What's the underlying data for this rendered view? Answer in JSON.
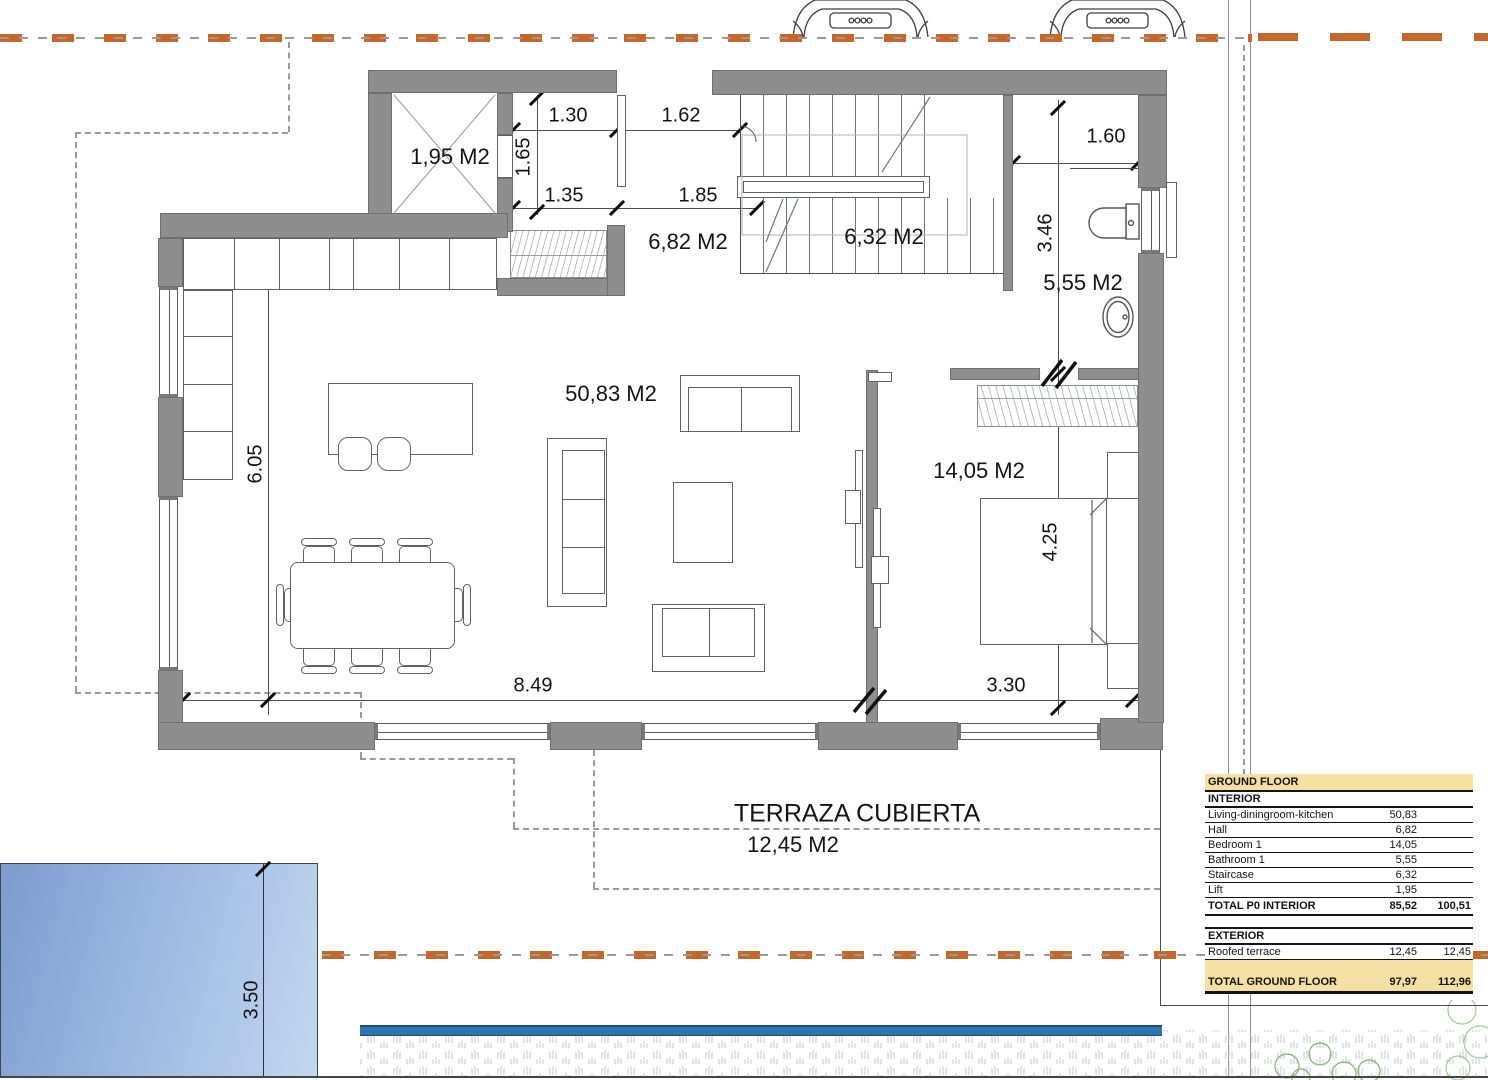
{
  "colors": {
    "wall": "#8e8e8e",
    "wall-edge": "#6f6f6f",
    "line": "#4d4d4d",
    "dash": "#9a9a9a",
    "orange": "#c5672b",
    "pool-dark": "#7e9bcf",
    "pool-light": "#c2d8ef",
    "strip": "#2e74b5",
    "strip-edge": "#1a4e79",
    "table-bg": "#f6dfa3",
    "hatch": "#b9bdc2",
    "bush": "#86b076"
  },
  "rooms": {
    "lift": "1,95 M2",
    "hall": "6,82 M2",
    "staircase": "6,32 M2",
    "bathroom": "5,55 M2",
    "living": "50,83 M2",
    "bedroom": "14,05 M2"
  },
  "terrace": {
    "title": "TERRAZA CUBIERTA",
    "area": "12,45 M2"
  },
  "dims": {
    "d130": "1.30",
    "d162": "1.62",
    "d165": "1.65",
    "d135": "1.35",
    "d185": "1.85",
    "d160": "1.60",
    "d346": "3.46",
    "d605": "6.05",
    "d425": "4.25",
    "d849": "8.49",
    "d330": "3.30",
    "d350": "3.50"
  },
  "icons": {
    "car": "car-front-outline-icon",
    "toilet": "toilet-plan-icon",
    "sink": "sink-plan-icon",
    "bush": "bush-plan-icon",
    "lift_cross": "lift-cross-icon"
  },
  "area_table": {
    "rows": [
      {
        "label": "GROUND FLOOR",
        "v1": "",
        "v2": "",
        "style": "header"
      },
      {
        "label": "INTERIOR",
        "v1": "",
        "v2": "",
        "style": "section"
      },
      {
        "label": "Living-diningroom-kitchen",
        "v1": "50,83",
        "v2": "",
        "style": "item"
      },
      {
        "label": "Hall",
        "v1": "6,82",
        "v2": "",
        "style": "item"
      },
      {
        "label": "Bedroom 1",
        "v1": "14,05",
        "v2": "",
        "style": "item"
      },
      {
        "label": "Bathroom 1",
        "v1": "5,55",
        "v2": "",
        "style": "item"
      },
      {
        "label": "Staircase",
        "v1": "6,32",
        "v2": "",
        "style": "item"
      },
      {
        "label": "Lift",
        "v1": "1,95",
        "v2": "",
        "style": "item"
      },
      {
        "label": "TOTAL P0 INTERIOR",
        "v1": "85,52",
        "v2": "100,51",
        "style": "total"
      },
      {
        "label": "",
        "v1": "",
        "v2": "",
        "style": "spacer"
      },
      {
        "label": "EXTERIOR",
        "v1": "",
        "v2": "",
        "style": "section"
      },
      {
        "label": "Roofed terrace",
        "v1": "12,45",
        "v2": "12,45",
        "style": "item"
      },
      {
        "label": "",
        "v1": "",
        "v2": "",
        "style": "spacer-yellow"
      },
      {
        "label": "TOTAL GROUND FLOOR",
        "v1": "97,97",
        "v2": "112,96",
        "style": "grand"
      }
    ]
  }
}
